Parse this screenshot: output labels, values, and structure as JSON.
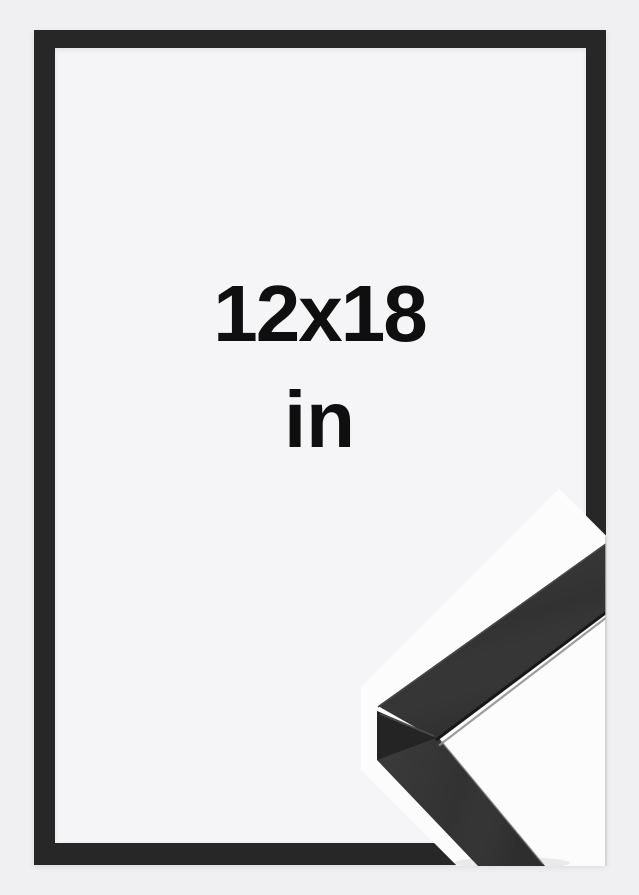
{
  "size_mockup": {
    "dimensions": "12x18",
    "unit": "in"
  },
  "colors": {
    "background": "#f0f0f2",
    "frame": "#272727",
    "mat": "#f5f5f7",
    "text": "#0f0f0f",
    "inset_background": "#fcfcfd",
    "moulding_face": "#323232",
    "moulding_side": "#242424",
    "moulding_lip_dark": "#181818",
    "moulding_lip_light": "#8d8d8d",
    "moulding_bevel": "#474747",
    "miter_line": "#4f4f4f",
    "divider_line": "#c4c4c8"
  }
}
